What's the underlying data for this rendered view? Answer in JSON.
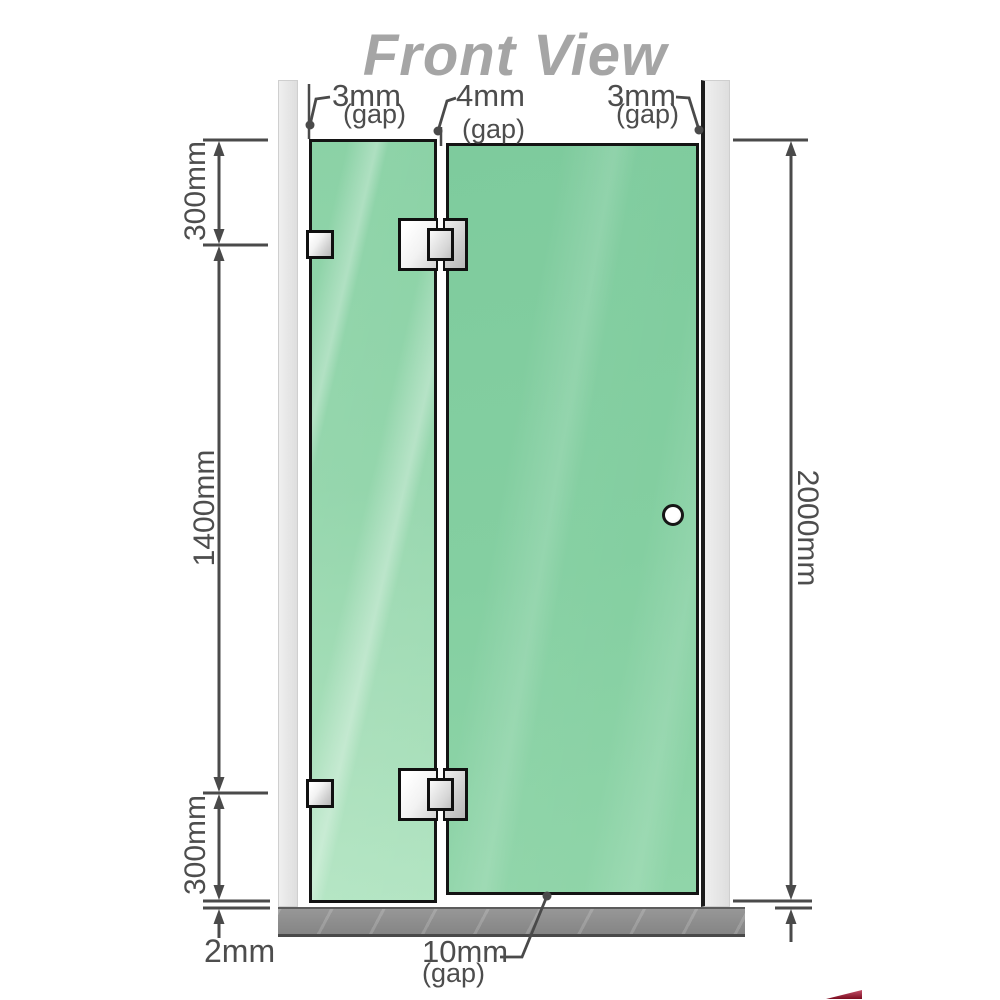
{
  "title": "Front View",
  "diagram": {
    "type": "shower-screen-front-elevation",
    "gaps": {
      "top_left": {
        "value": "3mm",
        "unit": "(gap)"
      },
      "top_middle": {
        "value": "4mm",
        "unit": "(gap)"
      },
      "top_right": {
        "value": "3mm",
        "unit": "(gap)"
      },
      "bottom": {
        "value": "10mm",
        "unit": "(gap)"
      }
    },
    "dimensions": {
      "upper_hinge_offset": "300mm",
      "hinge_spacing": "1400mm",
      "lower_hinge_offset": "300mm",
      "floor_gap": "2mm",
      "total_height": "2000mm"
    }
  },
  "colors": {
    "glass_fixed": "#94d6ac",
    "glass_door": "#84cfa1",
    "wall": "#e8e8e8",
    "floor": "#8c8c8c",
    "dimension_line": "#4a4a4a",
    "title_gray": "#a5a5a5",
    "corner_accent": "#7c0c20"
  }
}
